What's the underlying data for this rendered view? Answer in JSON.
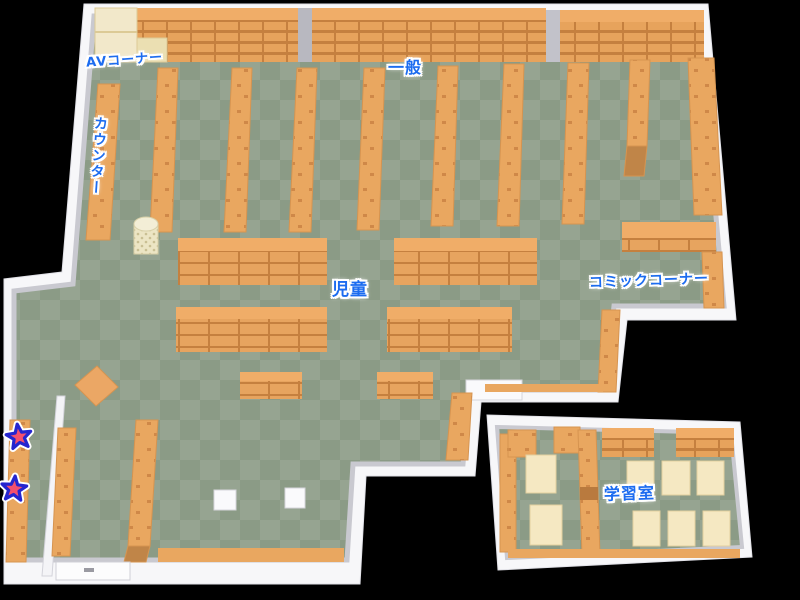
{
  "map": {
    "title": "library-floor-map",
    "areas": {
      "av_corner": "AVコーナー",
      "general": "一般",
      "counter": "カウンター",
      "children": "児童",
      "comic_corner": "コミックコーナー",
      "study_room": "学習室"
    },
    "markers": [
      {
        "type": "star",
        "fill": "#f4506e",
        "outline": "#2525cf"
      },
      {
        "type": "star",
        "fill": "#f4506e",
        "outline": "#2525cf"
      }
    ],
    "colors": {
      "background": "#000000",
      "wall": "#f7f7f9",
      "wall_shadow": "#c9c9d0",
      "floor_dark": "#8b9b86",
      "floor_light": "#96a491",
      "shelf": "#e9a760",
      "shelf_top": "#f0ad68",
      "shelf_line": "#c5803f",
      "shelf_end": "#c08548",
      "table": "#f5e8c2",
      "av_shelf": "#f2e8ca",
      "label_text": "#1c6cf0"
    }
  }
}
